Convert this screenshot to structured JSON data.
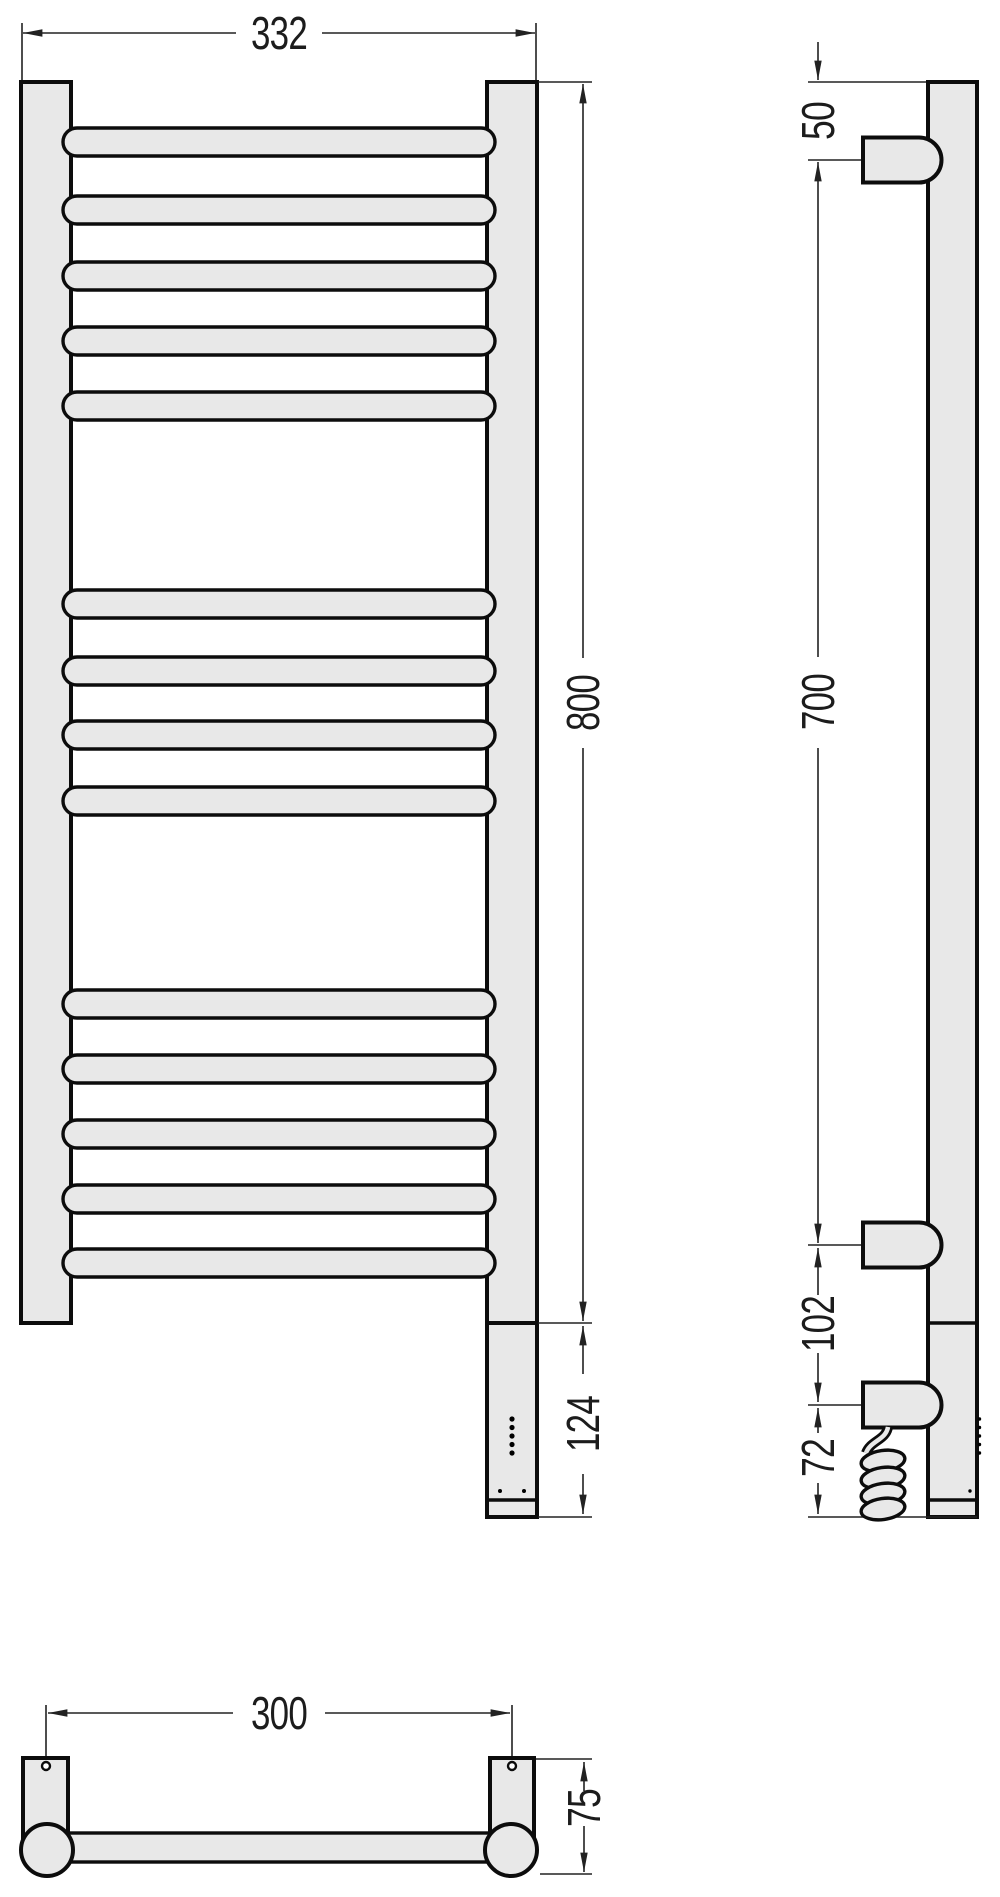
{
  "drawing": {
    "subject": "heated-towel-rail-technical-drawing",
    "views": [
      "front",
      "side",
      "bottom"
    ]
  },
  "dims": {
    "front_width": "332",
    "front_height": "800",
    "heater_height": "124",
    "side_top_offset": "50",
    "side_bracket_span": "700",
    "side_lower_gap": "102",
    "side_heater_gap": "72",
    "bottom_width": "300",
    "bottom_depth": "75"
  },
  "geometry": {
    "colors": {
      "fill": "#e8e8e8",
      "outline": "#0c0c0c",
      "dim": "#222222"
    },
    "front": {
      "bar": {
        "x": 63,
        "w": 432,
        "h": 28
      },
      "bar_tops": [
        128,
        196,
        262,
        327,
        392,
        590,
        657,
        721,
        787,
        990,
        1055,
        1120,
        1185,
        1249
      ],
      "led": {
        "cx": 512,
        "cys": [
          1419,
          1427.5,
          1436,
          1444.5,
          1453
        ],
        "r": 2.6
      },
      "screws": {
        "cy": 1491,
        "cxs": [
          500,
          524
        ],
        "r": 2
      }
    },
    "side": {
      "bracket_centers": [
        160,
        1245,
        1405
      ],
      "led": {
        "cx": 979.5,
        "cys": [
          1419,
          1427.5,
          1436,
          1444.5,
          1453
        ],
        "r": 1.7
      },
      "screw": {
        "cx": 970,
        "cy": 1491,
        "r": 1.7
      },
      "coil_cys": [
        1461,
        1478,
        1494,
        1509
      ]
    }
  }
}
